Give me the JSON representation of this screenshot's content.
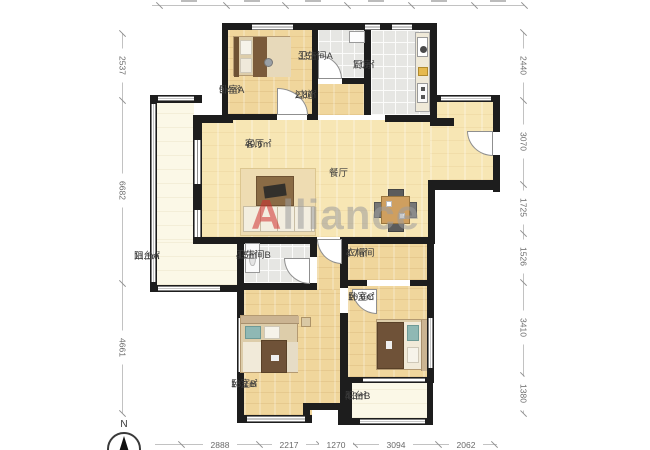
{
  "watermark": {
    "first_letter": "A",
    "rest": "lliance"
  },
  "compass": {
    "label": "N"
  },
  "rooms": [
    {
      "name": "卧室A",
      "area": "9.4㎡"
    },
    {
      "name": "卫生间A",
      "area": "3.5㎡"
    },
    {
      "name": "过道",
      "area": "2.8㎡"
    },
    {
      "name": "厨房",
      "area": "7.0㎡"
    },
    {
      "name": "客厅",
      "area": "40.6㎡"
    },
    {
      "name": "餐厅",
      "area": ""
    },
    {
      "name": "阳台A",
      "area": "11.1㎡"
    },
    {
      "name": "卫生间B",
      "area": "4.5㎡"
    },
    {
      "name": "衣帽间",
      "area": "4.7㎡"
    },
    {
      "name": "卧室C",
      "area": "10.6㎡"
    },
    {
      "name": "卧室B",
      "area": "18.1㎡"
    },
    {
      "name": "阳台B",
      "area": "4.3㎡"
    }
  ],
  "dimensions": {
    "left": [
      "2537",
      "6682",
      "4661"
    ],
    "right": [
      "2440",
      "3070",
      "1725",
      "1526",
      "3410",
      "1380"
    ],
    "bottom": [
      "2888",
      "2217",
      "1270",
      "3094",
      "2062"
    ]
  }
}
